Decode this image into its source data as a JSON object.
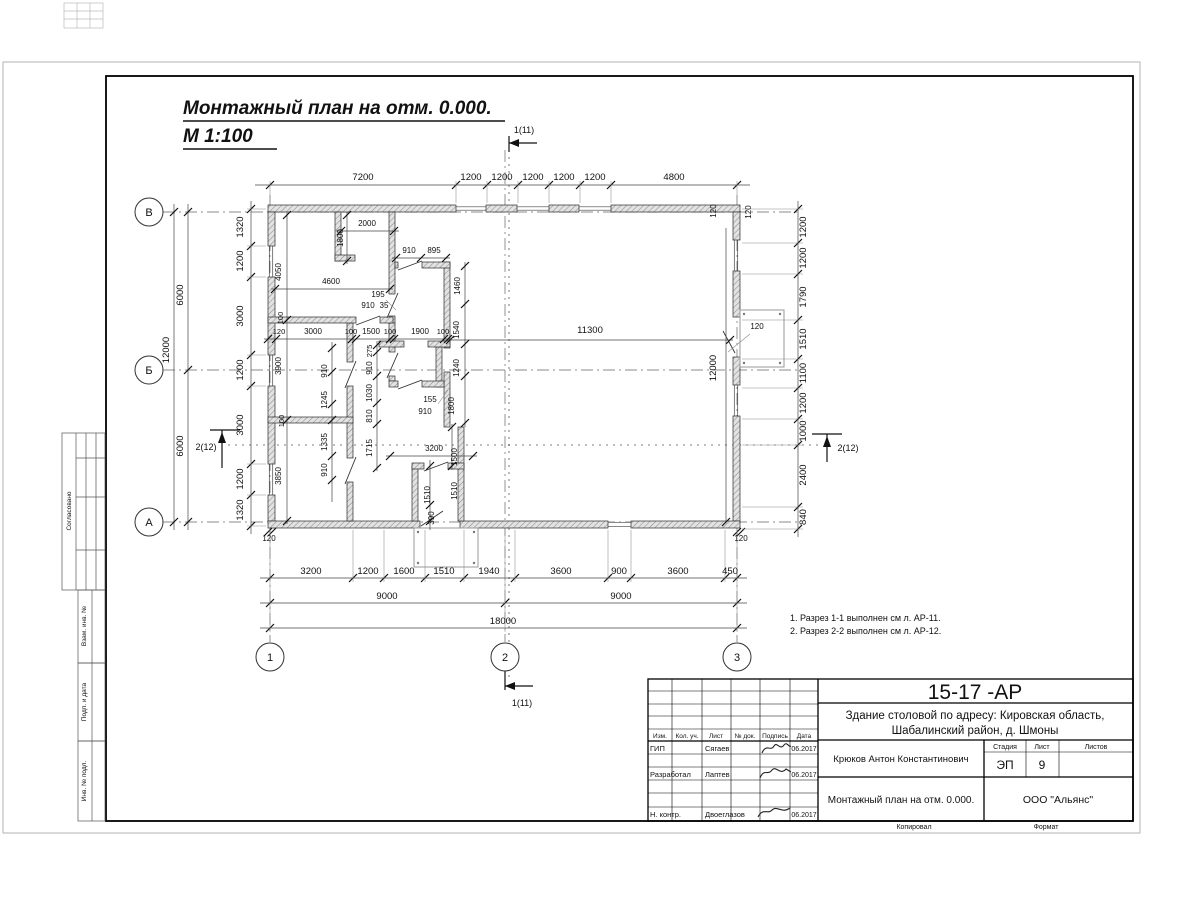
{
  "sheet": {
    "drawing_title_line1": "Монтажный план на отм. 0.000.",
    "drawing_title_line2": "М 1:100",
    "notes_line1": "1. Разрез 1-1 выполнен см л. АР-11.",
    "notes_line2": "2. Разрез 2-2 выполнен см л. АР-12.",
    "footer_copied": "Копировал",
    "footer_format": "Формат"
  },
  "axes": {
    "rows": [
      "В",
      "Б",
      "А"
    ],
    "cols": [
      "1",
      "2",
      "3"
    ]
  },
  "section_markers": {
    "vertical": "1(11)",
    "horizontal": "2(12)"
  },
  "side_strip": {
    "labels": [
      "Согласовано",
      "Взам. инв. №",
      "Подп. и дата",
      "Инв. № подл."
    ]
  },
  "title_block": {
    "doc_number": "15-17 -АР",
    "project_address_line1": "Здание столовой по адресу: Кировская область,",
    "project_address_line2": "Шабалинский район, д. Шмоны",
    "table_headers": [
      "Изм.",
      "Кол. уч.",
      "Лист",
      "№ док.",
      "Подпись",
      "Дата"
    ],
    "signature_rows": [
      {
        "role": "ГИП",
        "name": "Сягаев",
        "date": "06.2017"
      },
      {
        "role": "Разработал",
        "name": "Лаптев",
        "date": "06.2017"
      },
      {
        "role": "Н. контр.",
        "name": "Двоеглазов",
        "date": "06.2017"
      }
    ],
    "author": "Крюков Антон Константинович",
    "stage_label": "Стадия",
    "sheet_label": "Лист",
    "sheets_label": "Листов",
    "stage": "ЭП",
    "sheet_number": "9",
    "sheets_total": "",
    "drawing_name": "Монтажный план на отм. 0.000.",
    "company": "ООО \"Альянс\""
  },
  "dim_chains": {
    "top": [
      "7200",
      "1200",
      "1200",
      "1200",
      "1200",
      "1200",
      "4800"
    ],
    "bottom": [
      "3200",
      "1200",
      "1600",
      "1510",
      "1940",
      "3600",
      "900",
      "3600",
      "450"
    ],
    "bottom_halves": [
      "9000",
      "9000"
    ],
    "bottom_total": "18000",
    "left_outer": "12000",
    "left_halves": [
      "6000",
      "6000"
    ],
    "left_inner": [
      "1320",
      "1200",
      "3000",
      "1200",
      "3000",
      "1200",
      "1320"
    ],
    "right": [
      "1200",
      "1200",
      "1790",
      "1510",
      "1100",
      "1200",
      "1000",
      "2400",
      "840"
    ],
    "hall_width": "11300",
    "hall_depth": "12000",
    "wall_offset": "120"
  },
  "plan_texts": [
    {
      "t": "7200",
      "x": 363,
      "y": 180
    },
    {
      "t": "1200",
      "x": 471,
      "y": 180
    },
    {
      "t": "1200",
      "x": 502,
      "y": 180
    },
    {
      "t": "1200",
      "x": 533,
      "y": 180
    },
    {
      "t": "1200",
      "x": 564,
      "y": 180
    },
    {
      "t": "1200",
      "x": 595,
      "y": 180
    },
    {
      "t": "4800",
      "x": 674,
      "y": 180
    },
    {
      "t": "120",
      "x": 716,
      "y": 211,
      "r": -90,
      "s": 8
    },
    {
      "t": "120",
      "x": 751,
      "y": 212,
      "r": -90,
      "s": 8
    },
    {
      "t": "3200",
      "x": 311,
      "y": 574
    },
    {
      "t": "1200",
      "x": 368,
      "y": 574
    },
    {
      "t": "1600",
      "x": 404,
      "y": 574
    },
    {
      "t": "1510",
      "x": 444,
      "y": 574
    },
    {
      "t": "1940",
      "x": 489,
      "y": 574
    },
    {
      "t": "3600",
      "x": 561,
      "y": 574
    },
    {
      "t": "900",
      "x": 619,
      "y": 574
    },
    {
      "t": "3600",
      "x": 678,
      "y": 574
    },
    {
      "t": "450",
      "x": 730,
      "y": 574
    },
    {
      "t": "9000",
      "x": 387,
      "y": 599
    },
    {
      "t": "9000",
      "x": 621,
      "y": 599
    },
    {
      "t": "18000",
      "x": 503,
      "y": 624
    },
    {
      "t": "12000",
      "x": 169,
      "y": 350,
      "r": -90
    },
    {
      "t": "6000",
      "x": 183,
      "y": 295,
      "r": -90
    },
    {
      "t": "6000",
      "x": 183,
      "y": 446,
      "r": -90
    },
    {
      "t": "1320",
      "x": 243,
      "y": 227,
      "r": -90
    },
    {
      "t": "1200",
      "x": 243,
      "y": 261,
      "r": -90
    },
    {
      "t": "3000",
      "x": 243,
      "y": 316,
      "r": -90
    },
    {
      "t": "1200",
      "x": 243,
      "y": 370,
      "r": -90
    },
    {
      "t": "3000",
      "x": 243,
      "y": 425,
      "r": -90
    },
    {
      "t": "1200",
      "x": 243,
      "y": 479,
      "r": -90
    },
    {
      "t": "1320",
      "x": 243,
      "y": 510,
      "r": -90
    },
    {
      "t": "1200",
      "x": 806,
      "y": 227,
      "r": -90
    },
    {
      "t": "1200",
      "x": 806,
      "y": 258,
      "r": -90
    },
    {
      "t": "1790",
      "x": 806,
      "y": 297,
      "r": -90
    },
    {
      "t": "1510",
      "x": 806,
      "y": 339,
      "r": -90
    },
    {
      "t": "1100",
      "x": 806,
      "y": 373,
      "r": -90
    },
    {
      "t": "1200",
      "x": 806,
      "y": 403,
      "r": -90
    },
    {
      "t": "1000",
      "x": 806,
      "y": 431,
      "r": -90
    },
    {
      "t": "2400",
      "x": 806,
      "y": 475,
      "r": -90
    },
    {
      "t": "840",
      "x": 806,
      "y": 517,
      "r": -90
    },
    {
      "t": "120",
      "x": 269,
      "y": 541,
      "s": 8
    },
    {
      "t": "120",
      "x": 741,
      "y": 541,
      "s": 8
    },
    {
      "t": "11300",
      "x": 590,
      "y": 333
    },
    {
      "t": "12000",
      "x": 716,
      "y": 368,
      "r": -90
    },
    {
      "t": "120",
      "x": 757,
      "y": 329,
      "s": 8
    },
    {
      "t": "2000",
      "x": 367,
      "y": 226,
      "s": 8
    },
    {
      "t": "1800",
      "x": 343,
      "y": 238,
      "r": -90,
      "s": 8
    },
    {
      "t": "4600",
      "x": 331,
      "y": 284,
      "s": 8
    },
    {
      "t": "910",
      "x": 409,
      "y": 253,
      "s": 8
    },
    {
      "t": "895",
      "x": 434,
      "y": 253,
      "s": 8
    },
    {
      "t": "195",
      "x": 378,
      "y": 297,
      "s": 8
    },
    {
      "t": "910",
      "x": 368,
      "y": 308,
      "s": 8
    },
    {
      "t": "35",
      "x": 384,
      "y": 308,
      "s": 8
    },
    {
      "t": "1460",
      "x": 460,
      "y": 286,
      "r": -90,
      "s": 8
    },
    {
      "t": "1540",
      "x": 459,
      "y": 330,
      "r": -90,
      "s": 8
    },
    {
      "t": "1240",
      "x": 459,
      "y": 368,
      "r": -90,
      "s": 8
    },
    {
      "t": "1800",
      "x": 454,
      "y": 406,
      "r": -90,
      "s": 8
    },
    {
      "t": "4050",
      "x": 281,
      "y": 272,
      "r": -90,
      "s": 8
    },
    {
      "t": "3900",
      "x": 281,
      "y": 366,
      "r": -90,
      "s": 8
    },
    {
      "t": "3850",
      "x": 281,
      "y": 476,
      "r": -90,
      "s": 8
    },
    {
      "t": "100",
      "x": 283,
      "y": 318,
      "r": -90,
      "s": 7.5
    },
    {
      "t": "100",
      "x": 284,
      "y": 421,
      "r": -90,
      "s": 7.5
    },
    {
      "t": "910",
      "x": 327,
      "y": 371,
      "r": -90,
      "s": 8
    },
    {
      "t": "1245",
      "x": 327,
      "y": 400,
      "r": -90,
      "s": 8
    },
    {
      "t": "1335",
      "x": 327,
      "y": 442,
      "r": -90,
      "s": 8
    },
    {
      "t": "910",
      "x": 327,
      "y": 470,
      "r": -90,
      "s": 8
    },
    {
      "t": "120",
      "x": 279,
      "y": 334,
      "s": 7.5
    },
    {
      "t": "3000",
      "x": 313,
      "y": 334,
      "s": 8
    },
    {
      "t": "100",
      "x": 351,
      "y": 334,
      "s": 7.5
    },
    {
      "t": "1500",
      "x": 371,
      "y": 334,
      "s": 8
    },
    {
      "t": "100",
      "x": 390,
      "y": 334,
      "s": 7.5
    },
    {
      "t": "1900",
      "x": 420,
      "y": 334,
      "s": 8
    },
    {
      "t": "100",
      "x": 443,
      "y": 334,
      "s": 7.5
    },
    {
      "t": "275",
      "x": 372,
      "y": 351,
      "r": -90,
      "s": 7.5
    },
    {
      "t": "910",
      "x": 372,
      "y": 368,
      "r": -90,
      "s": 8
    },
    {
      "t": "1030",
      "x": 372,
      "y": 393,
      "r": -90,
      "s": 8
    },
    {
      "t": "810",
      "x": 372,
      "y": 416,
      "r": -90,
      "s": 8
    },
    {
      "t": "1715",
      "x": 372,
      "y": 448,
      "r": -90,
      "s": 8
    },
    {
      "t": "155",
      "x": 430,
      "y": 402,
      "s": 8
    },
    {
      "t": "910",
      "x": 425,
      "y": 414,
      "s": 8
    },
    {
      "t": "3200",
      "x": 434,
      "y": 451,
      "s": 8
    },
    {
      "t": "1500",
      "x": 457,
      "y": 457,
      "r": -90,
      "s": 8
    },
    {
      "t": "1510",
      "x": 430,
      "y": 495,
      "r": -90,
      "s": 8
    },
    {
      "t": "1510",
      "x": 457,
      "y": 491,
      "r": -90,
      "s": 8
    },
    {
      "t": "390",
      "x": 434,
      "y": 518,
      "r": -90,
      "s": 8
    },
    {
      "t": "1(11)",
      "x": 524,
      "y": 133,
      "s": 9
    },
    {
      "t": "1(11)",
      "x": 522,
      "y": 706,
      "s": 9
    },
    {
      "t": "2(12)",
      "x": 206,
      "y": 450,
      "s": 9
    },
    {
      "t": "2(12)",
      "x": 848,
      "y": 451,
      "s": 9
    }
  ]
}
